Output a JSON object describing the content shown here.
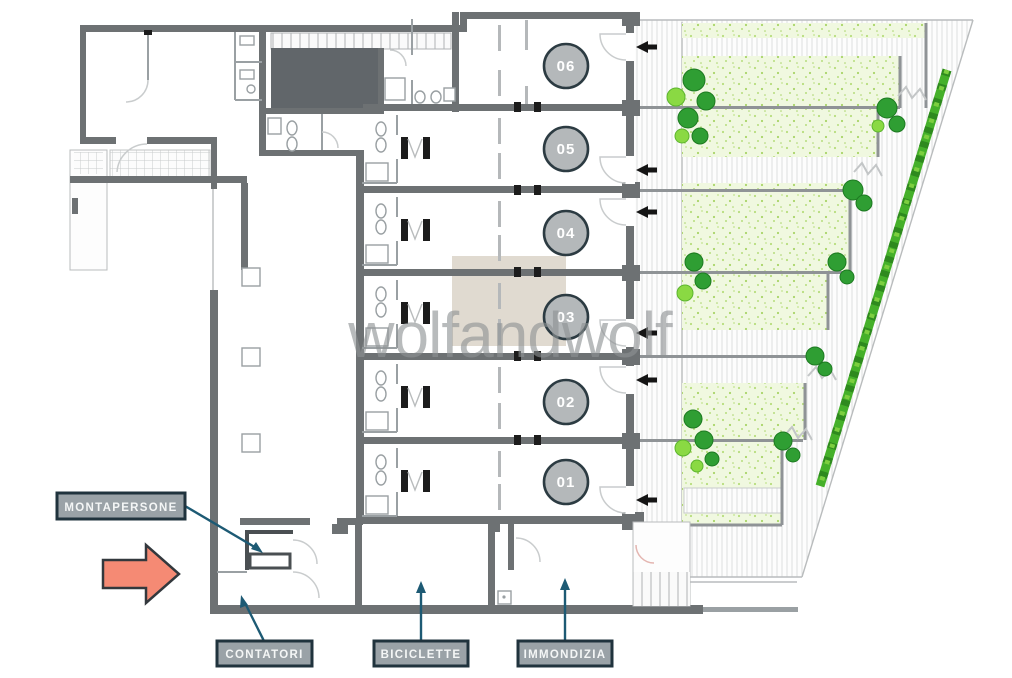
{
  "watermark": "wolfandwolf",
  "units": [
    {
      "number": "06"
    },
    {
      "number": "05"
    },
    {
      "number": "04"
    },
    {
      "number": "03"
    },
    {
      "number": "02"
    },
    {
      "number": "01"
    }
  ],
  "annotations": {
    "montapersone": {
      "label": "MONTAPERSONE"
    },
    "contatori": {
      "label": "CONTATORI"
    },
    "biciclette": {
      "label": "BICICLETTE"
    },
    "immondizia": {
      "label": "IMMONDIZIA"
    }
  },
  "icons": {
    "entrance_arrows": "arrow-left-icon",
    "direction_arrow": "orange-right-arrow-icon"
  },
  "colors": {
    "wall": "#6d7173",
    "unit_badge_fill": "#b4b8ba",
    "unit_badge_border": "#2c3b42",
    "label_background": "#9aa2a7",
    "label_border": "#20333d",
    "leader_teal": "#1d5a74",
    "orange_arrow": "#f58a74",
    "lawn_green": "#f0f8e0",
    "tree_green": "#2f9e33",
    "hedge_green": "#45b02a",
    "watermark_gray": "#8e9294",
    "highlight_beige": "#ddd6cb"
  }
}
